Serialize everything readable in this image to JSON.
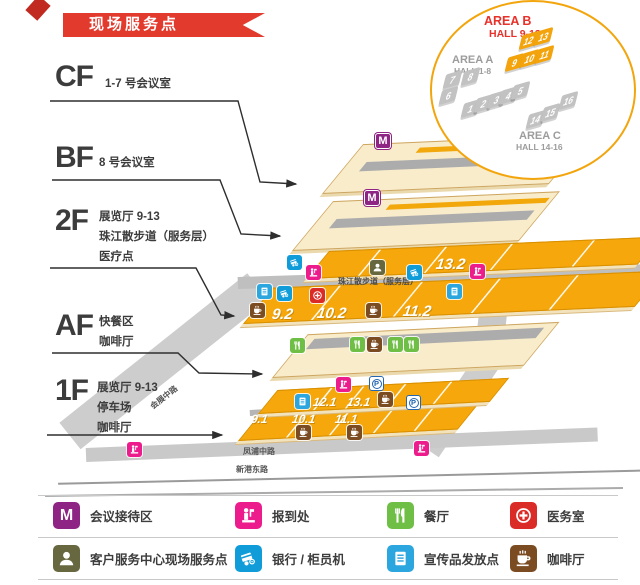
{
  "banner": {
    "title": "现场服务点"
  },
  "floors": [
    {
      "label": "CF",
      "lines": [
        "1-7 号会议室"
      ]
    },
    {
      "label": "BF",
      "lines": [
        "8 号会议室"
      ]
    },
    {
      "label": "2F",
      "lines": [
        "展览厅 9-13",
        "珠江散步道（服务层）",
        "医疗点"
      ]
    },
    {
      "label": "AF",
      "lines": [
        "快餐区",
        "咖啡厅"
      ]
    },
    {
      "label": "1F",
      "lines": [
        "展览厅 9-13",
        "停车场",
        "咖啡厅"
      ]
    }
  ],
  "inset": {
    "area_a": {
      "name": "AREA A",
      "range": "HALL 1-8",
      "halls": [
        "1",
        "2",
        "3",
        "4",
        "5",
        "6",
        "7",
        "8"
      ]
    },
    "area_b": {
      "name": "AREA B",
      "range": "HALL 9-13",
      "halls": [
        "9",
        "10",
        "11",
        "12",
        "13"
      ]
    },
    "area_c": {
      "name": "AREA C",
      "range": "HALL 14-16",
      "halls": [
        "14",
        "15",
        "16"
      ]
    }
  },
  "map": {
    "walkway": "珠江散步道（服务层）",
    "m_badge": "M",
    "parking_badge": "P",
    "halls": {
      "h13_2": "13.2",
      "h9_2": "9.2",
      "h10_2": "10.2",
      "h11_2": "11.2",
      "h12_1": "12.1",
      "h13_1": "13.1",
      "h9_1": "9.1",
      "h10_1": "10.1",
      "h11_1": "11.1"
    },
    "roads": {
      "middle": "会展中路",
      "east": "会展东路",
      "south": "凤浦中路",
      "south_outer": "新港东路"
    }
  },
  "legend": {
    "items": [
      {
        "name": "meeting-reception",
        "label": "会议接待区",
        "color": "#8E2484",
        "glyph": "M"
      },
      {
        "name": "registration",
        "label": "报到处",
        "color": "#EC1C8D"
      },
      {
        "name": "restaurant",
        "label": "餐厅",
        "color": "#6FBE45"
      },
      {
        "name": "medical",
        "label": "医务室",
        "color": "#DB2B27"
      },
      {
        "name": "customer-service",
        "label": "客户服务中心现场服务点",
        "color": "#67683F"
      },
      {
        "name": "bank-atm",
        "label": "银行 / 柜员机",
        "color": "#0F9CD8"
      },
      {
        "name": "brochure",
        "label": "宣传品发放点",
        "color": "#2BA6DE"
      },
      {
        "name": "coffee",
        "label": "咖啡厅",
        "color": "#7B4C22"
      }
    ]
  }
}
